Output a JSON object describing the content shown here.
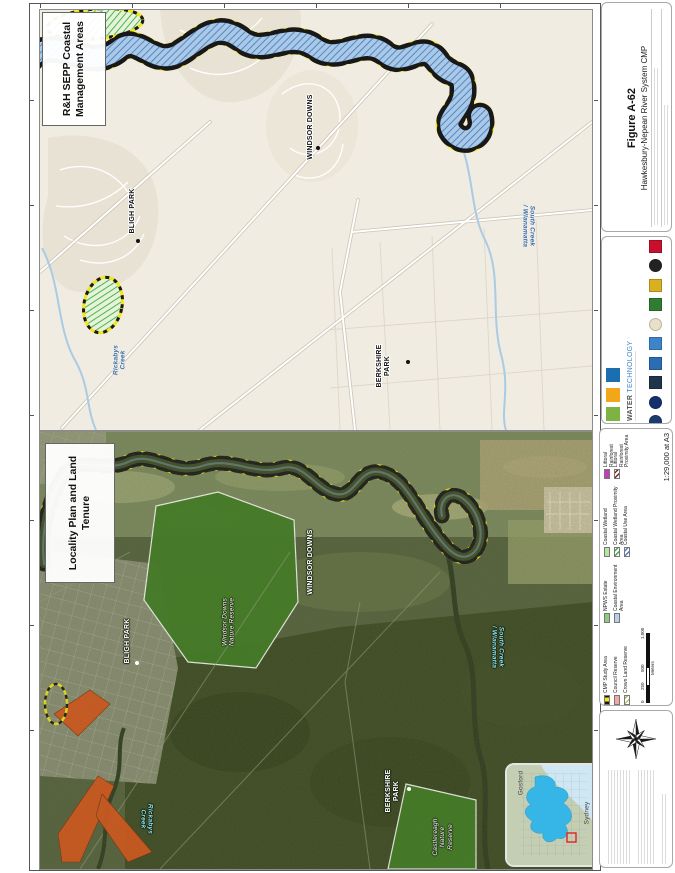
{
  "figure_panel": {
    "figure_number": "Figure A-62",
    "figure_title": "Hawkesbury-Nepean River System CMP",
    "scale_text": "1:29,000 at A3"
  },
  "top_map": {
    "title": "R&H SEPP Coastal Management Areas"
  },
  "bottom_map": {
    "title": "Locality Plan and Land Tenure",
    "reserves": {
      "windsor_downs_nr": "Windsor Downs Nature Reserve",
      "castlereagh_nr": "Castlereagh Nature Reserve"
    }
  },
  "places": {
    "windsor_downs": "WINDSOR DOWNS",
    "bligh_park": "BLIGH PARK",
    "berkshire_park": "BERKSHIRE PARK"
  },
  "creeks": {
    "south_creek": "South Creek / Wianamatta",
    "rickabys_creek": "Rickabys Creek"
  },
  "legend": {
    "items": [
      {
        "label": "CMP Study Area"
      },
      {
        "label": "Council Reserve"
      },
      {
        "label": "Crown Land Reserve"
      },
      {
        "label": "NPWS Estate"
      },
      {
        "label": "Coastal Environment Area"
      },
      {
        "label": "Coastal Wetland"
      },
      {
        "label": "Coastal Wetland Proximity Area"
      },
      {
        "label": "Coastal Use Area"
      },
      {
        "label": "Littoral Rainforest"
      },
      {
        "label": "Littoral Rainforest Proximity Area"
      }
    ],
    "scalebar": {
      "t0": "0",
      "t1": "250",
      "t2": "500",
      "t3": "1,000",
      "unit": "Meters"
    }
  },
  "inset_map": {
    "gosford": "Gosford",
    "sydney": "Sydney"
  },
  "logos": {
    "water_technology": {
      "label_1": "WATER",
      "label_2": "TECHNOLOGY",
      "colors": [
        "#7cb342",
        "#f2a71b",
        "#1c6fae"
      ]
    },
    "partners": [
      {
        "color": "#1b3d6e"
      },
      {
        "color": "#14306e"
      },
      {
        "color": "#20344a"
      },
      {
        "color": "#2a6db5"
      },
      {
        "color": "#3d85c8"
      },
      {
        "color": "#e8e0c8"
      },
      {
        "color": "#2f7d32"
      },
      {
        "color": "#d8b020"
      },
      {
        "color": "#222222"
      },
      {
        "color": "#c8102e"
      }
    ]
  },
  "colors": {
    "cmp_boundary_yellow": "#f2e61a",
    "coastal_use_hatch_blue": "#4a7fc0",
    "wetland_hatch_green": "#3fae3f",
    "npws_green": "#3f7d20",
    "littoral_magenta": "#c73bbf",
    "reserve_orange": "#dd5418"
  }
}
